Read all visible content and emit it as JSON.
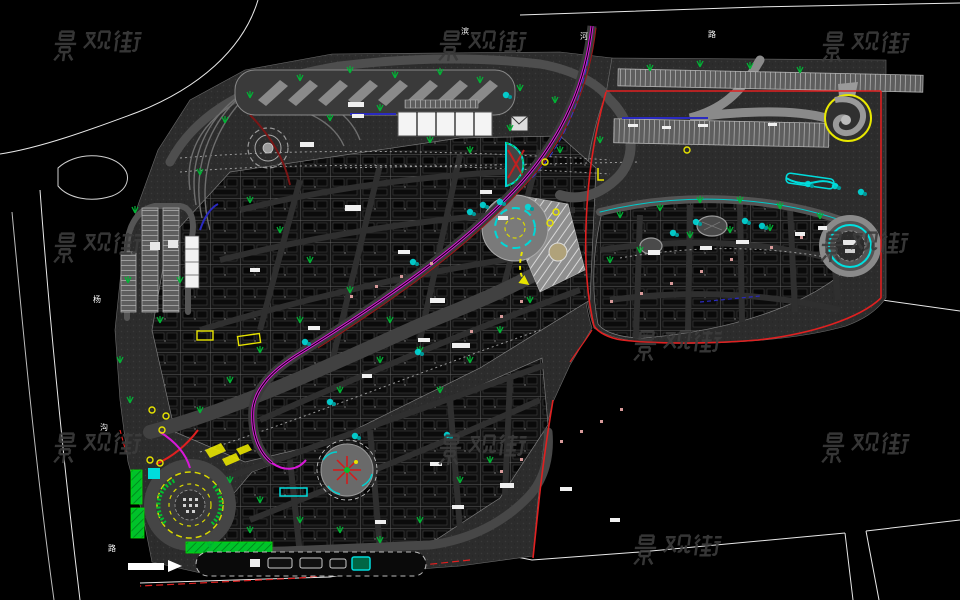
{
  "document": {
    "type": "CAD landscape site plan drawing",
    "background_color": "#000000"
  },
  "watermark": {
    "text": "景观街",
    "color": "#3c3c3c",
    "positions": [
      [
        98,
        46
      ],
      [
        483,
        46
      ],
      [
        866,
        47
      ],
      [
        98,
        248
      ],
      [
        865,
        247
      ],
      [
        678,
        346
      ],
      [
        98,
        448
      ],
      [
        483,
        450
      ],
      [
        866,
        448
      ],
      [
        678,
        550
      ]
    ]
  },
  "road_labels": {
    "color": "#ffffff",
    "items": [
      {
        "text": "滨",
        "x": 461,
        "y": 34
      },
      {
        "text": "河",
        "x": 580,
        "y": 39
      },
      {
        "text": "路",
        "x": 708,
        "y": 37
      },
      {
        "text": "杨",
        "x": 93,
        "y": 302
      },
      {
        "text": "沟",
        "x": 100,
        "y": 430
      },
      {
        "text": "路",
        "x": 108,
        "y": 551
      }
    ]
  },
  "legend_colors": {
    "boundary_red": "#e02020",
    "pedestrian_street_magenta": "#d818d8",
    "water_cyan": "#00dcdc",
    "planting_green": "#00c030",
    "lawn_bright_green": "#00e000",
    "highlight_yellow": "#e8e400",
    "plan_gray": "#2d2d2d",
    "line_white": "#ffffff"
  }
}
